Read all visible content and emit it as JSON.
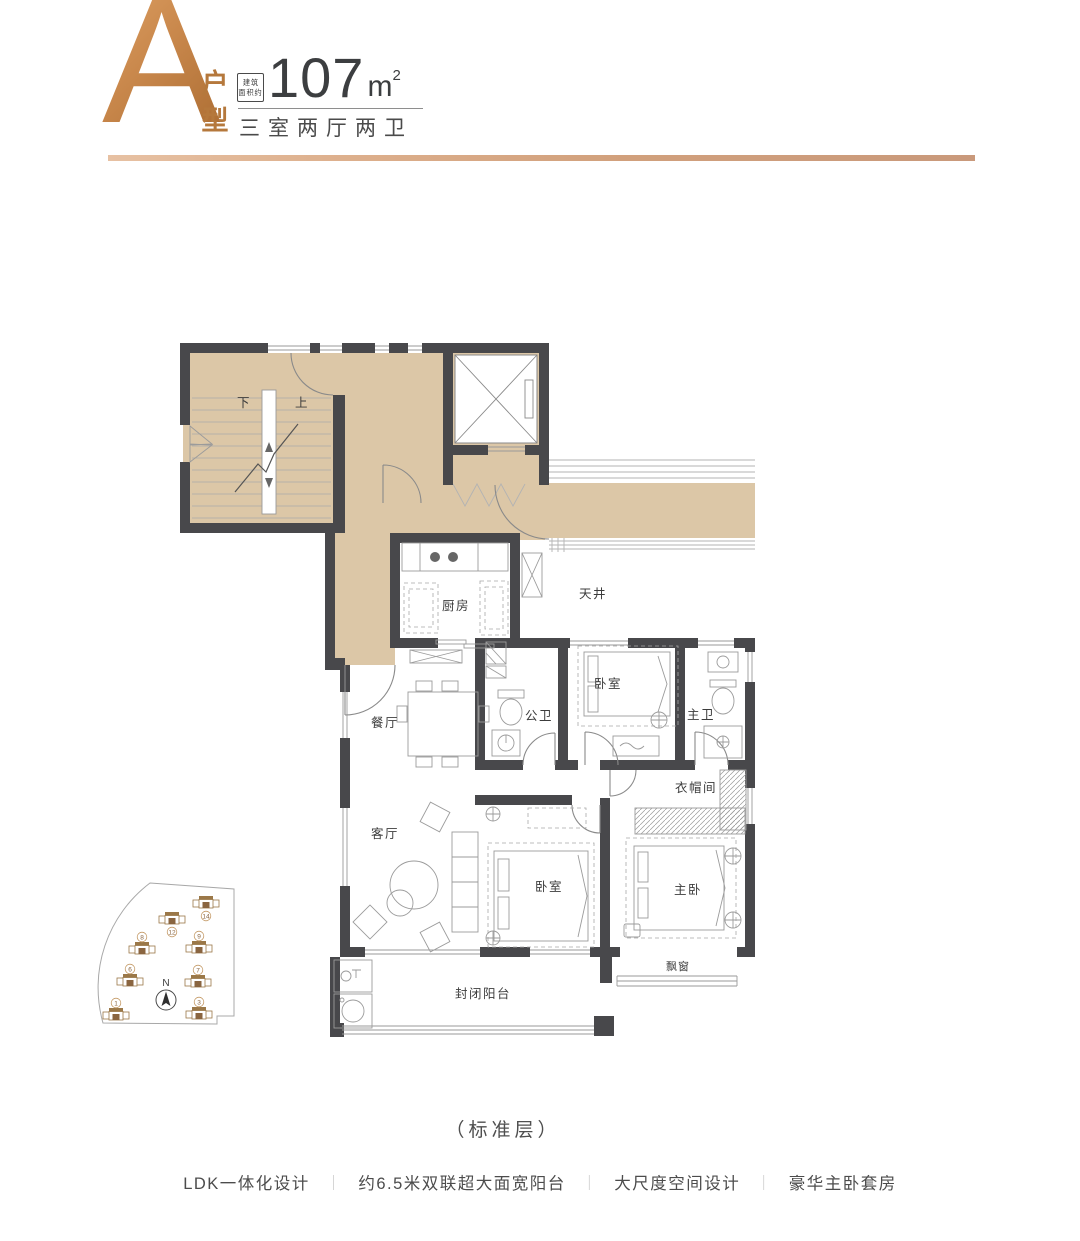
{
  "header": {
    "unit_letter": "A",
    "unit_type_label": "户型",
    "area_badge_line1": "建筑",
    "area_badge_line2": "面积约",
    "area_value": "107",
    "area_unit": "m",
    "area_exponent": "2",
    "layout_text": "三室两厅两卫"
  },
  "plan": {
    "stair_down": "下",
    "stair_up": "上",
    "rooms": {
      "kitchen": "厨房",
      "lightwell": "天井",
      "dining": "餐厅",
      "guest_bath": "公卫",
      "bedroom_north": "卧室",
      "master_bath": "主卫",
      "living": "客厅",
      "bedroom_south": "卧室",
      "cloakroom": "衣帽间",
      "master_bedroom": "主卧",
      "balcony": "封闭阳台",
      "bay_window": "飘窗"
    }
  },
  "keyplan": {
    "north_label": "N",
    "buildings": [
      {
        "no": "1",
        "x": 30,
        "y": 137,
        "ny": 125
      },
      {
        "no": "3",
        "x": 113,
        "y": 136,
        "ny": 124
      },
      {
        "no": "6",
        "x": 44,
        "y": 103,
        "ny": 91
      },
      {
        "no": "7",
        "x": 112,
        "y": 104,
        "ny": 92
      },
      {
        "no": "8",
        "x": 56,
        "y": 71,
        "ny": 59
      },
      {
        "no": "9",
        "x": 113,
        "y": 70,
        "ny": 58
      },
      {
        "no": "12",
        "x": 86,
        "y": 41,
        "ny": 54
      },
      {
        "no": "14",
        "x": 120,
        "y": 25,
        "ny": 38
      }
    ]
  },
  "caption": "（标准层）",
  "footer": {
    "separator": "｜",
    "features": [
      "LDK一体化设计",
      "约6.5米双联超大面宽阳台",
      "大尺度空间设计",
      "豪华主卧套房"
    ]
  },
  "colors": {
    "copper": "#c07f44",
    "copper-dark": "#a96a30",
    "copper-light": "#dca06a",
    "beige": "#dcc7a7",
    "wall": "#48484b",
    "ink": "#3d3d3d"
  }
}
